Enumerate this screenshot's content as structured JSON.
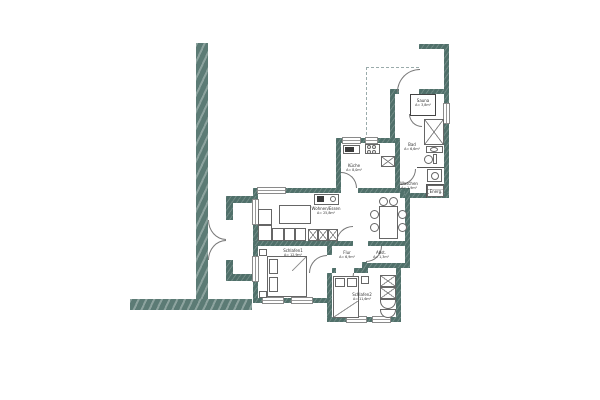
{
  "plan_title": "",
  "colors": {
    "apartment_wall": "#50706a",
    "freestanding_wall": "#5c7b75",
    "thin_line": "#555555",
    "dashed_line": "#9aabab",
    "background": "#ffffff"
  },
  "rooms": [
    {
      "id": "wohnen",
      "label": "Wohnen/Essen",
      "area": "A= 25,8m²"
    },
    {
      "id": "kueche",
      "label": "Küche",
      "area": "A= 8,0m²"
    },
    {
      "id": "bad",
      "label": "Bad",
      "area": "A= 6,6m²"
    },
    {
      "id": "sauna",
      "label": "Sauna",
      "area": "A= 3,8m²"
    },
    {
      "id": "waschen",
      "label": "Waschen",
      "area": "A= 1,9m²"
    },
    {
      "id": "energ",
      "label": "Energ.",
      "area": ""
    },
    {
      "id": "flur",
      "label": "Flur",
      "area": "A= 6,9m²"
    },
    {
      "id": "abst",
      "label": "Abst.",
      "area": "A= 1,3m²"
    },
    {
      "id": "schlafen1",
      "label": "Schlafen1",
      "area": "A= 12,9m²"
    },
    {
      "id": "schlafen2",
      "label": "Schlafen2",
      "area": "A= 11,6m²"
    }
  ]
}
